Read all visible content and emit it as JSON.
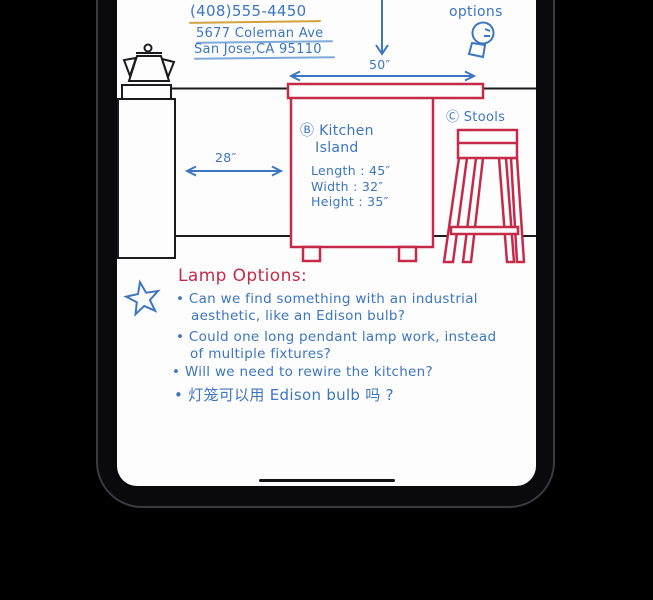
{
  "device": {
    "home_indicator": "home-indicator"
  },
  "contact": {
    "phone": "(408)555-4450",
    "address1": "5677 Coleman Ave",
    "address2": "San Jose,CA 95110"
  },
  "options_note": "options",
  "diagram": {
    "island": {
      "tag": "Ⓑ",
      "name_line1": "Kitchen",
      "name_line2": "Island",
      "width_label": "50″",
      "dimensions": [
        "Length : 45″",
        "Width : 32″",
        "Height : 35″"
      ]
    },
    "gap_label": "28″",
    "stools": {
      "tag": "Ⓒ",
      "label": "Stools"
    }
  },
  "notes": {
    "heading": "Lamp Options:",
    "lines": [
      "• Can we find something with an industrial",
      "aesthetic, like an Edison bulb?",
      "• Could one long pendant lamp work, instead",
      "of multiple fixtures?",
      "• Will we need to rewire the kitchen?",
      "• 灯笼可以用 Edison bulb 吗 ?"
    ]
  },
  "colors": {
    "ink_blue": "#3c76c1",
    "ink_red": "#c52b49",
    "ink_black": "#1b1b1d",
    "underline_yellow": "#d2a33c",
    "underline_blue": "#7ea9da",
    "screen_bg": "#fdfdfe",
    "background": "#000000"
  }
}
